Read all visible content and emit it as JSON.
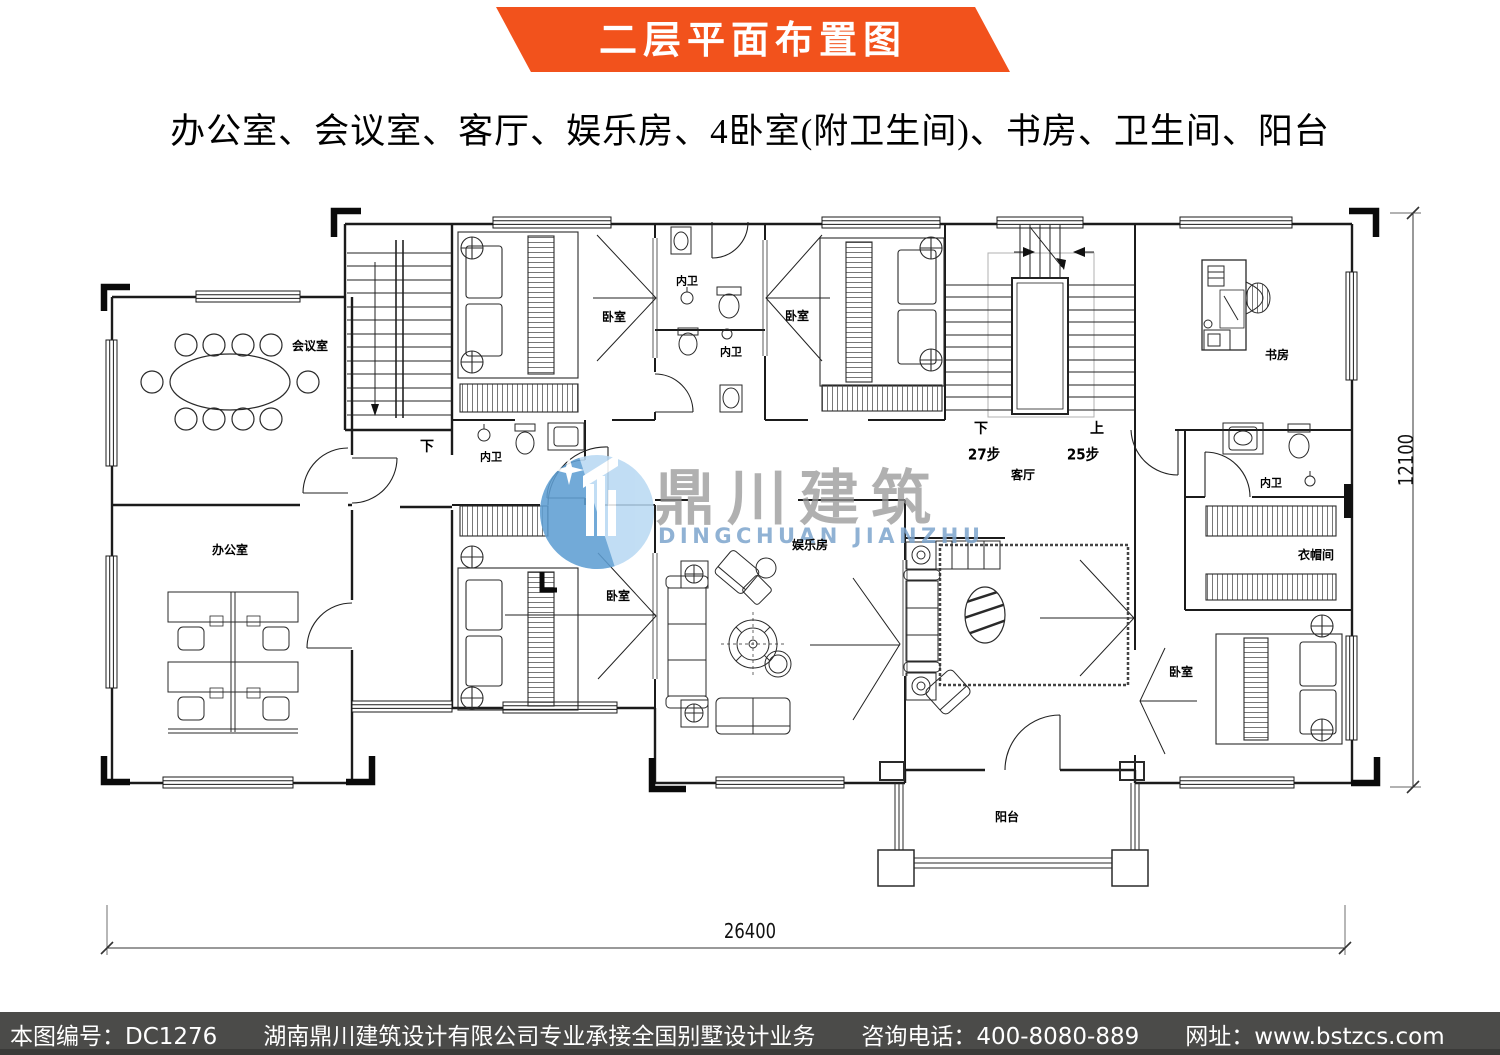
{
  "header": {
    "title": "二层平面布置图",
    "banner_color": "#f2521c"
  },
  "subtitle": "办公室、会议室、客厅、娱乐房、4卧室(附卫生间)、书房、卫生间、阳台",
  "watermark": {
    "brand": "鼎川建筑",
    "brand_en": "DINGCHUAN JIANZHU"
  },
  "plan": {
    "room_labels": [
      {
        "label": "会议室"
      },
      {
        "label": "办公室"
      },
      {
        "label": "卧室"
      },
      {
        "label": "内卫"
      },
      {
        "label": "内卫"
      },
      {
        "label": "卧室"
      },
      {
        "label": "书房"
      },
      {
        "label": "内卫"
      },
      {
        "label": "客厅"
      },
      {
        "label": "内卫"
      },
      {
        "label": "衣帽间"
      },
      {
        "label": "卧室"
      },
      {
        "label": "娱乐房"
      },
      {
        "label": "卧室"
      },
      {
        "label": "阳台"
      }
    ],
    "stair_labels": [
      {
        "label": "下"
      },
      {
        "label": "下"
      },
      {
        "label": "27步"
      },
      {
        "label": "上"
      },
      {
        "label": "25步"
      }
    ],
    "dimensions": {
      "width": "26400",
      "height": "12100"
    }
  },
  "footer": {
    "drawing_no": "本图编号：DC1276",
    "company": "湖南鼎川建筑设计有限公司专业承接全国别墅设计业务",
    "phone": "咨询电话：400-8080-889",
    "website": "网址：www.bstzcs.com"
  }
}
